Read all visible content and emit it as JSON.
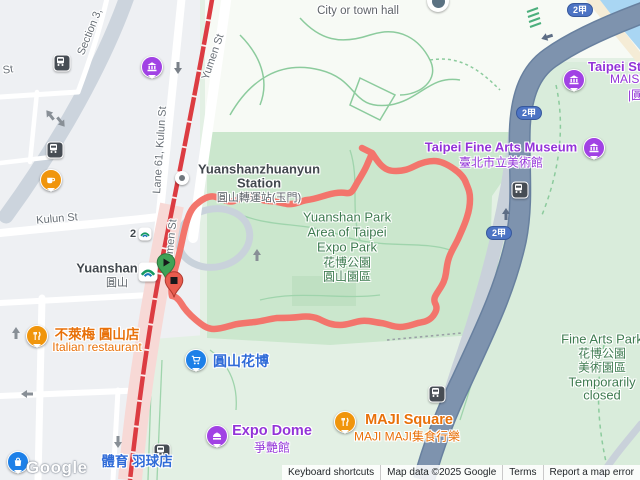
{
  "attribution": {
    "keyboard_shortcuts": "Keyboard shortcuts",
    "map_data": "Map data ©2025 Google",
    "terms": "Terms",
    "report_error": "Report a map error"
  },
  "watermark": "Google",
  "highway_shield": "2甲",
  "station_exit": "2",
  "streets": {
    "section3": "Section 3,",
    "st_partial": "St",
    "kulun": "Kulun St",
    "lane61": "Lane 61, Kulun St",
    "yumen": "Yumen St",
    "yumen_south": "Yumen St"
  },
  "pois": {
    "city_hall": {
      "name": "City or town hall"
    },
    "zhuanyun": {
      "line1": "Yuanshanzhuanyun",
      "line2": "Station",
      "zh": "圓山轉運站(玉門)"
    },
    "yuanshan": {
      "name": "Yuanshan",
      "zh": "圓山"
    },
    "expo_park": {
      "line1": "Yuanshan Park",
      "line2": "Area of Taipei",
      "line3": "Expo Park",
      "zh1": "花博公園",
      "zh2": "圓山園區"
    },
    "tfam": {
      "name": "Taipei Fine Arts Museum",
      "zh": "臺北市立美術館"
    },
    "taipei_st": {
      "line1": "Taipei St",
      "line2": "MAISO",
      "line3": "|圓"
    },
    "fine_arts_park": {
      "line1": "Fine Arts Park",
      "zh1": "花博公園",
      "zh2": "美術園區",
      "line2": "Temporarily",
      "line3": "closed"
    },
    "bremen": {
      "zh": "不萊梅 圓山店",
      "sub": "Italian restaurant"
    },
    "yuanshan_huabo": {
      "zh": "圓山花博"
    },
    "expo_dome": {
      "name": "Expo Dome",
      "zh": "爭艷館"
    },
    "maji": {
      "name": "MAJI Square",
      "zh": "MAJI MAJI集食行樂"
    },
    "badminton": {
      "zh": "體育 羽球店"
    }
  },
  "route": {
    "color": "#f3756c"
  }
}
